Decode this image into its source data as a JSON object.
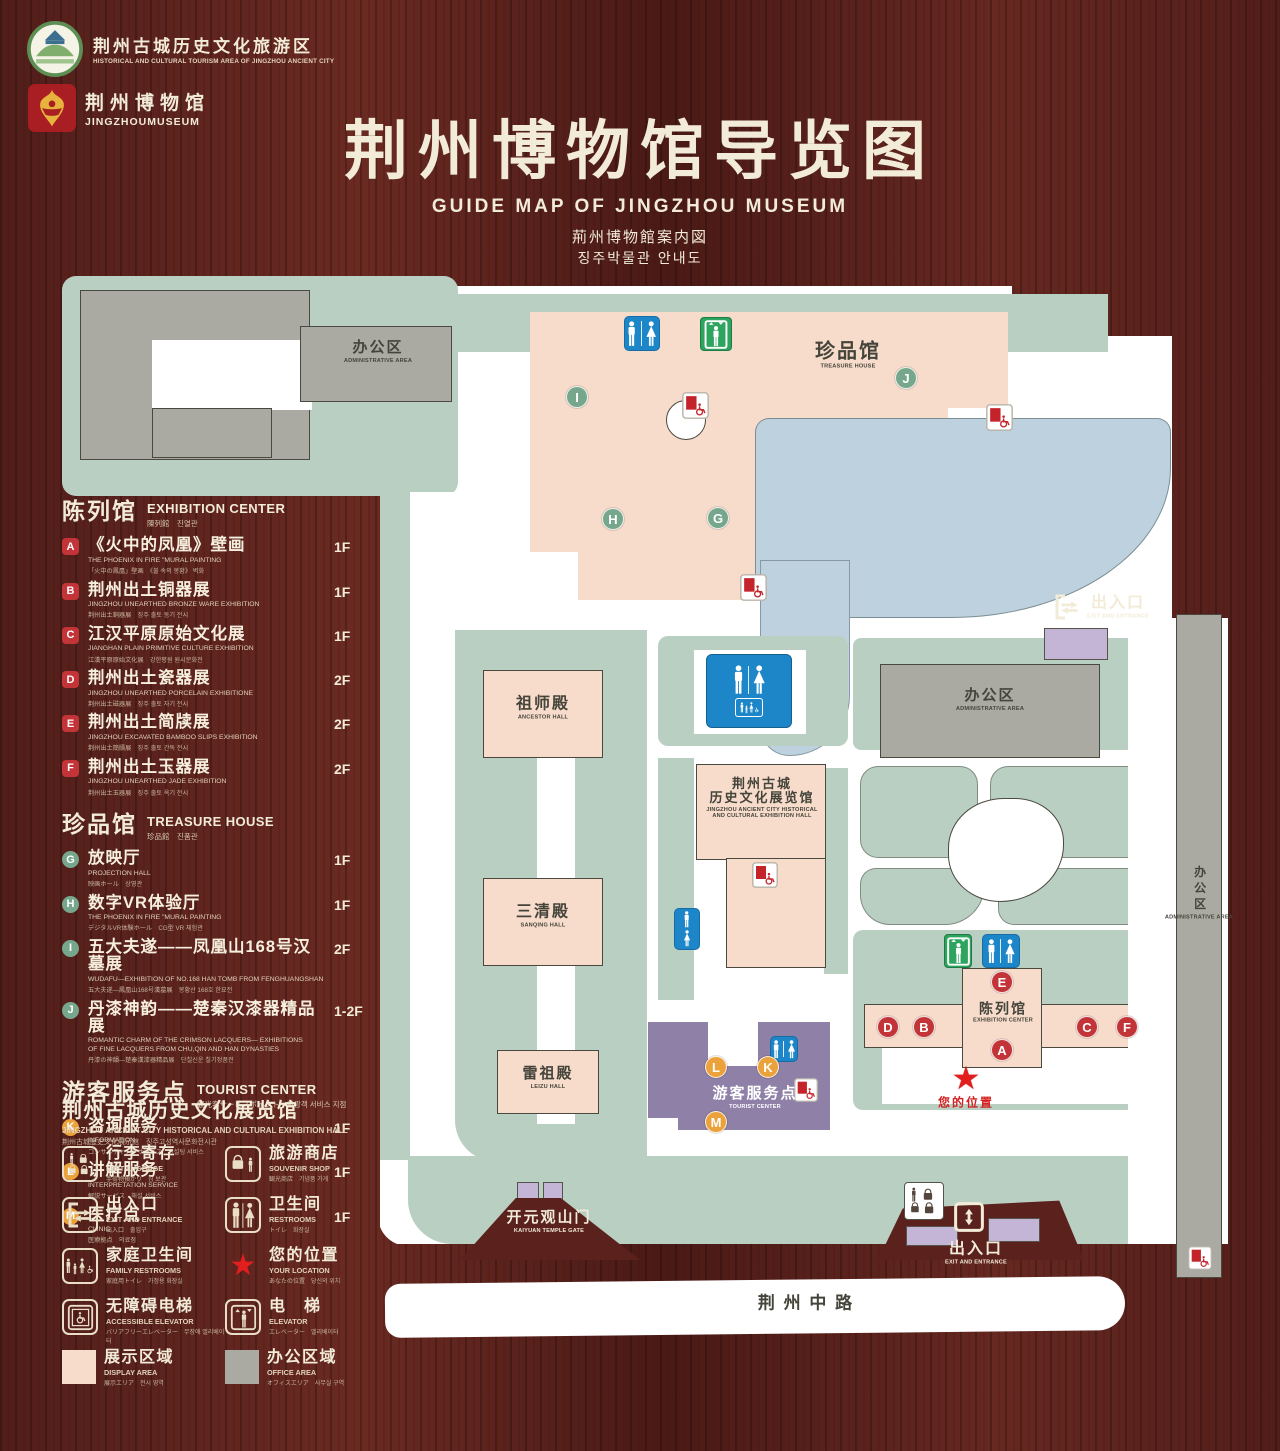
{
  "header": {
    "logo1": {
      "title": "荆州古城历史文化旅游区",
      "subtitle": "HISTORICAL AND CULTURAL TOURISM AREA OF JINGZHOU ANCIENT CITY"
    },
    "logo2": {
      "title": "荆州博物馆",
      "subtitle": "JINGZHOUMUSEUM"
    },
    "title": "荆州博物馆导览图",
    "subtitle_en": "GUIDE MAP OF JINGZHOU MUSEUM",
    "subtitle_jp": "荊州博物館案内図",
    "subtitle_kr": "징주박물관 안내도"
  },
  "legend": {
    "sections": [
      {
        "id": "exhibition-center",
        "title_cn": "陈列馆",
        "title_en": "EXHIBITION CENTER",
        "title_sub": "陳列館　진열관",
        "badge": "sq",
        "items": [
          {
            "letter": "A",
            "cn": "《火中的凤凰》壁画",
            "en": "THE PHOENIX IN FIRE \"MURAL PAINTING",
            "sub": "「火中の鳳凰」壁画　《불 속의 봉황》 벽화",
            "floor": "1F"
          },
          {
            "letter": "B",
            "cn": "荆州出土铜器展",
            "en": "JINGZHOU UNEARTHED BRONZE WARE EXHIBITION",
            "sub": "荆州出土銅器展　징주 출토 동기 전시",
            "floor": "1F"
          },
          {
            "letter": "C",
            "cn": "江汉平原原始文化展",
            "en": "JIANGHAN PLAIN PRIMITIVE CULTURE EXHIBITION",
            "sub": "江漢平原原始文化展　강한평원 원시문화전",
            "floor": "1F"
          },
          {
            "letter": "D",
            "cn": "荆州出土瓷器展",
            "en": "JINGZHOU UNEARTHED PORCELAIN EXHIBITIONE",
            "sub": "荆州出土磁器展　징주 출토 자기 전시",
            "floor": "2F"
          },
          {
            "letter": "E",
            "cn": "荆州出土简牍展",
            "en": "JINGZHOU EXCAVATED BAMBOO SLIPS EXHIBITION",
            "sub": "荆州出土簡牘展　징주 출토 간독 전시",
            "floor": "2F"
          },
          {
            "letter": "F",
            "cn": "荆州出土玉器展",
            "en": "JINGZHOU UNEARTHED JADE EXHIBITION",
            "sub": "荆州出土玉器展　징주 출토 옥기 전시",
            "floor": "2F"
          }
        ]
      },
      {
        "id": "treasure-house",
        "title_cn": "珍品馆",
        "title_en": "TREASURE HOUSE",
        "title_sub": "珍品館　진품관",
        "badge": "g",
        "items": [
          {
            "letter": "G",
            "cn": "放映厅",
            "en": "PROJECTION HALL",
            "sub": "映画ホール　상영관",
            "floor": "1F"
          },
          {
            "letter": "H",
            "cn": "数字VR体验厅",
            "en": "THE PHOENIX IN FIRE \"MURAL PAINTING",
            "sub": "デジタルVR体験ホール　CG型 VR 체험관",
            "floor": "1F"
          },
          {
            "letter": "I",
            "cn": "五大夫遂——凤凰山168号汉墓展",
            "en": "WUDAFU—EXHIBITION OF NO.168 HAN TOMB FROM FENGHUANGSHAN",
            "sub": "五大夫遂—鳳凰山168号漢墓展　봉황산 168호 한묘전",
            "floor": "2F"
          },
          {
            "letter": "J",
            "cn": "丹漆神韵——楚秦汉漆器精品展",
            "en": "ROMANTIC CHARM OF THE CRIMSON LACQUERS— EXHIBITIONS\nOF FINE LACQUERS FROM CHU,QIN AND HAN DYNASTIES",
            "sub": "丹漆の神韻—楚秦漢漆器精品展　단칠신운 칠기정품전",
            "floor": "1-2F"
          }
        ]
      },
      {
        "id": "tourist-center",
        "title_cn": "游客服务点",
        "title_en": "TOURIST CENTER",
        "title_sub": "観光客サービスポイント　관광객 서비스 지점",
        "badge": "o",
        "items": [
          {
            "letter": "K",
            "cn": "咨询服务",
            "en": "INFORMATION",
            "sub": "コンサルティングサービス　컨설팅 서비스",
            "floor": "1F"
          },
          {
            "letter": "L",
            "cn": "讲解服务",
            "en": "INTERPRETATION SERVICE",
            "sub": "解説サービス　해설 서비스",
            "floor": "1F"
          },
          {
            "letter": "M",
            "cn": "医疗点",
            "en": "CLINIC",
            "sub": "医療拠点　의료점",
            "floor": "1F"
          }
        ]
      }
    ],
    "hall_note": {
      "cn": "荆州古城历史文化展览馆",
      "en": "JINGZHOU ANCIENT CITY HISTORICAL AND CULTURAL EXHIBITION HALL",
      "sub": "荆州古城歴史文化展示館　징주고성역사문화전시관"
    },
    "icons": [
      {
        "id": "left-luggage",
        "cn": "行李寄存",
        "en": "LEFT LUGGAGE",
        "sub": "手荷物預かり　짐 보관"
      },
      {
        "id": "souvenir-shop",
        "cn": "旅游商店",
        "en": "SOUVENIR SHOP",
        "sub": "観光商店　기념품 가게"
      },
      {
        "id": "exit-entrance",
        "cn": "出入口",
        "en": "EXIT AND ENTRANCE",
        "sub": "出入口　출입구"
      },
      {
        "id": "restrooms",
        "cn": "卫生间",
        "en": "RESTROOMS",
        "sub": "トイレ　화장실"
      },
      {
        "id": "family-restrooms",
        "cn": "家庭卫生间",
        "en": "FAMILY RESTROOMS",
        "sub": "家庭用トイレ　가정용 화장실"
      },
      {
        "id": "your-location",
        "cn": "您的位置",
        "en": "YOUR LOCATION",
        "sub": "あなたの位置　당신의 위치"
      },
      {
        "id": "accessible-elevator",
        "cn": "无障碍电梯",
        "en": "ACCESSIBLE ELEVATOR",
        "sub": "バリアフリーエレベーター　무장애 엘리베이터"
      },
      {
        "id": "elevator",
        "cn": "电　梯",
        "en": "ELEVATOR",
        "sub": "エレベーター　엘리베이터"
      },
      {
        "id": "display-area",
        "cn": "展示区域",
        "en": "DISPLAY AREA",
        "sub": "展示エリア　전시 영역"
      },
      {
        "id": "office-area",
        "cn": "办公区域",
        "en": "OFFICE AREA",
        "sub": "オフィスエリア　사무실 구역"
      }
    ],
    "area_colors": {
      "display_area": "#f7dccc",
      "office_area": "#abaaa2"
    }
  },
  "map": {
    "colors": {
      "ground_green": "#b9cfc2",
      "building_pink": "#f7dccc",
      "building_gray": "#abaaa2",
      "lake_blue": "#bdd2de",
      "tourist_purple": "#8f80a8",
      "gate_lilac": "#c4b5d6",
      "restroom_blue": "#1d86c8",
      "elevator_green": "#2ea55f",
      "marker_red": "#c23438",
      "marker_green": "#76a78c",
      "marker_orange": "#eca23b",
      "location_red": "#e31e1e"
    },
    "labels": [
      {
        "id": "admin-area-topleft",
        "style": "dark",
        "cn": "办公区",
        "en": "ADMINISTRATIVE AREA",
        "x": 378,
        "y": 352,
        "cs": 15
      },
      {
        "id": "treasure-house",
        "style": "dark",
        "cn": "珍品馆",
        "en": "TREASURE HOUSE",
        "x": 848,
        "y": 355,
        "cs": 20
      },
      {
        "id": "ancestor-hall",
        "style": "dark",
        "cn": "祖师殿",
        "en": "ANCESTOR HALL",
        "x": 543,
        "y": 708,
        "cs": 16
      },
      {
        "id": "sanqing-hall",
        "style": "dark",
        "cn": "三清殿",
        "en": "SANQING HALL",
        "x": 543,
        "y": 916,
        "cs": 16
      },
      {
        "id": "leizu-hall",
        "style": "dark",
        "cn": "雷祖殿",
        "en": "LEIZU HALL",
        "x": 548,
        "y": 1078,
        "cs": 15
      },
      {
        "id": "jingzhou-exhibition-hall",
        "style": "dark",
        "cn": "荆州古城\n历史文化展览馆",
        "en": "JINGZHOU ANCIENT CITY HISTORICAL\nAND CULTURAL EXHIBITION HALL",
        "x": 762,
        "y": 798,
        "cs": 13
      },
      {
        "id": "admin-area-mid",
        "style": "dark",
        "cn": "办公区",
        "en": "ADMINISTRATIVE AREA",
        "x": 990,
        "y": 700,
        "cs": 15
      },
      {
        "id": "admin-area-right",
        "style": "dark vert",
        "cn": "办公区",
        "en": "ADMINISTRATIVE AREA",
        "x": 1199,
        "y": 893,
        "cs": 12
      },
      {
        "id": "exhibition-center",
        "style": "dark",
        "cn": "陈列馆",
        "en": "EXHIBITION CENTER",
        "x": 1003,
        "y": 1013,
        "cs": 14
      },
      {
        "id": "tourist-center",
        "style": "whitey",
        "cn": "游客服务点",
        "en": "TOURIST CENTER",
        "x": 755,
        "y": 1098,
        "cs": 15
      },
      {
        "id": "kaiyuan-temple-gate",
        "style": "cream",
        "cn": "开元观山门",
        "en": "KAIYUAN TEMPLE GATE",
        "x": 549,
        "y": 1222,
        "cs": 15
      },
      {
        "id": "exit-right",
        "style": "cream",
        "cn": "出入口",
        "en": "EXIT AND ENTRANCE",
        "x": 1118,
        "y": 607,
        "cs": 16
      },
      {
        "id": "exit-bottom",
        "style": "cream",
        "cn": "出入口",
        "en": "EXIT AND ENTRANCE",
        "x": 976,
        "y": 1253,
        "cs": 16
      },
      {
        "id": "your-location",
        "style": "redtxt",
        "cn": "您的位置",
        "x": 966,
        "y": 1103,
        "cs": 12
      },
      {
        "id": "road",
        "style": "dark",
        "cn": "荆 州 中 路",
        "x": 806,
        "y": 1304,
        "cs": 17
      }
    ],
    "markers": [
      {
        "t": "g",
        "l": "I",
        "x": 577,
        "y": 397
      },
      {
        "t": "g",
        "l": "J",
        "x": 906,
        "y": 378
      },
      {
        "t": "g",
        "l": "H",
        "x": 613,
        "y": 519
      },
      {
        "t": "g",
        "l": "G",
        "x": 718,
        "y": 518
      },
      {
        "t": "r",
        "l": "E",
        "x": 1002,
        "y": 982
      },
      {
        "t": "r",
        "l": "A",
        "x": 1002,
        "y": 1050
      },
      {
        "t": "r",
        "l": "D",
        "x": 888,
        "y": 1027
      },
      {
        "t": "r",
        "l": "B",
        "x": 924,
        "y": 1027
      },
      {
        "t": "r",
        "l": "C",
        "x": 1087,
        "y": 1027
      },
      {
        "t": "r",
        "l": "F",
        "x": 1127,
        "y": 1027
      },
      {
        "t": "o",
        "l": "K",
        "x": 768,
        "y": 1067
      },
      {
        "t": "o",
        "l": "L",
        "x": 716,
        "y": 1067
      },
      {
        "t": "o",
        "l": "M",
        "x": 716,
        "y": 1122
      }
    ]
  }
}
